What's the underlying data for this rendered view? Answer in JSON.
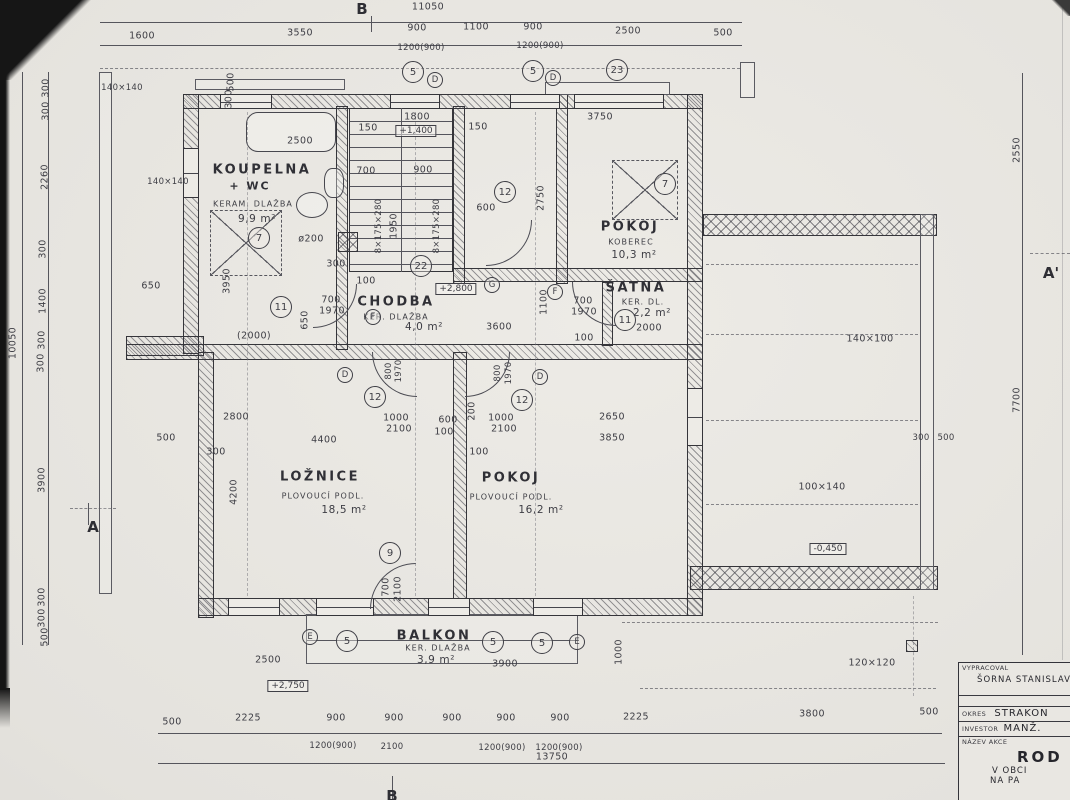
{
  "title_block": {
    "vypracoval_label": "VYPRACOVAL",
    "vypracoval": "ŠORNA STANISLAV",
    "okres_label": "OKRES",
    "okres": "STRAKON",
    "investor_label": "INVESTOR",
    "investor": "MANŽ.",
    "nazev_label": "NÁZEV AKCE",
    "nazev1": "ROD",
    "nazev2": "V OBCI",
    "nazev3": "NA PA"
  },
  "rooms": [
    {
      "name": "KOUPELNA + WC",
      "floor": "KERAM. DLAŽBA",
      "area": "9,9 m²"
    },
    {
      "name": "CHODBA",
      "floor": "KER. DLAŽBA",
      "area": "4,0 m²"
    },
    {
      "name": "POKOJ",
      "floor": "KOBEREC",
      "area": "10,3 m²"
    },
    {
      "name": "ŠATNA",
      "floor": "KER. DL.",
      "area": "2,2 m²"
    },
    {
      "name": "LOŽNICE",
      "floor": "PLOVOUCÍ PODL.",
      "area": "18,5 m²"
    },
    {
      "name": "POKOJ",
      "floor": "PLOVOUCÍ PODL.",
      "area": "16,2 m²"
    },
    {
      "name": "BALKON",
      "floor": "KER. DLAŽBA",
      "area": "3,9 m²"
    }
  ],
  "labels": [
    {
      "t": "B",
      "x": 362,
      "y": 9,
      "cls": "axis",
      "name": "axis-b-top"
    },
    {
      "t": "B",
      "x": 392,
      "y": 796,
      "cls": "axis",
      "name": "axis-b-bottom"
    },
    {
      "t": "A",
      "x": 93,
      "y": 527,
      "cls": "axis",
      "name": "section-a"
    },
    {
      "t": "A'",
      "x": 1051,
      "y": 273,
      "cls": "axis",
      "name": "section-a-prime"
    },
    {
      "t": "11050",
      "x": 428,
      "y": 7,
      "cls": "dim"
    },
    {
      "t": "1600",
      "x": 142,
      "y": 36,
      "cls": "dim"
    },
    {
      "t": "3550",
      "x": 300,
      "y": 33,
      "cls": "dim"
    },
    {
      "t": "900",
      "x": 417,
      "y": 28,
      "cls": "dim"
    },
    {
      "t": "1200(900)",
      "x": 421,
      "y": 48,
      "cls": "dim-sub"
    },
    {
      "t": "1100",
      "x": 476,
      "y": 27,
      "cls": "dim"
    },
    {
      "t": "900",
      "x": 533,
      "y": 27,
      "cls": "dim"
    },
    {
      "t": "1200(900)",
      "x": 540,
      "y": 46,
      "cls": "dim-sub"
    },
    {
      "t": "2500",
      "x": 628,
      "y": 31,
      "cls": "dim"
    },
    {
      "t": "500",
      "x": 723,
      "y": 33,
      "cls": "dim"
    },
    {
      "t": "10050",
      "x": 13,
      "y": 343,
      "cls": "dim",
      "rot": 1
    },
    {
      "t": "300",
      "x": 46,
      "y": 88,
      "cls": "dim",
      "rot": 1
    },
    {
      "t": "300",
      "x": 46,
      "y": 111,
      "cls": "dim",
      "rot": 1
    },
    {
      "t": "2260",
      "x": 45,
      "y": 177,
      "cls": "dim",
      "rot": 1
    },
    {
      "t": "300",
      "x": 43,
      "y": 249,
      "cls": "dim",
      "rot": 1
    },
    {
      "t": "1400",
      "x": 43,
      "y": 301,
      "cls": "dim",
      "rot": 1
    },
    {
      "t": "300",
      "x": 42,
      "y": 340,
      "cls": "dim",
      "rot": 1
    },
    {
      "t": "300",
      "x": 41,
      "y": 363,
      "cls": "dim",
      "rot": 1
    },
    {
      "t": "3900",
      "x": 42,
      "y": 480,
      "cls": "dim",
      "rot": 1
    },
    {
      "t": "300",
      "x": 42,
      "y": 597,
      "cls": "dim",
      "rot": 1
    },
    {
      "t": "300",
      "x": 42,
      "y": 618,
      "cls": "dim",
      "rot": 1
    },
    {
      "t": "500",
      "x": 45,
      "y": 637,
      "cls": "dim",
      "rot": 1
    },
    {
      "t": "2550",
      "x": 1017,
      "y": 150,
      "cls": "dim",
      "rot": 1
    },
    {
      "t": "7700",
      "x": 1017,
      "y": 400,
      "cls": "dim",
      "rot": 1
    },
    {
      "t": "500",
      "x": 172,
      "y": 722,
      "cls": "dim"
    },
    {
      "t": "2225",
      "x": 248,
      "y": 718,
      "cls": "dim"
    },
    {
      "t": "900",
      "x": 336,
      "y": 718,
      "cls": "dim"
    },
    {
      "t": "1200(900)",
      "x": 333,
      "y": 746,
      "cls": "dim-sub"
    },
    {
      "t": "900",
      "x": 394,
      "y": 718,
      "cls": "dim"
    },
    {
      "t": "2100",
      "x": 392,
      "y": 747,
      "cls": "dim-sub"
    },
    {
      "t": "900",
      "x": 452,
      "y": 718,
      "cls": "dim"
    },
    {
      "t": "900",
      "x": 506,
      "y": 718,
      "cls": "dim"
    },
    {
      "t": "1200(900)",
      "x": 502,
      "y": 748,
      "cls": "dim-sub"
    },
    {
      "t": "900",
      "x": 560,
      "y": 718,
      "cls": "dim"
    },
    {
      "t": "1200(900)",
      "x": 559,
      "y": 748,
      "cls": "dim-sub"
    },
    {
      "t": "2225",
      "x": 636,
      "y": 717,
      "cls": "dim"
    },
    {
      "t": "3800",
      "x": 812,
      "y": 714,
      "cls": "dim"
    },
    {
      "t": "500",
      "x": 929,
      "y": 712,
      "cls": "dim"
    },
    {
      "t": "13750",
      "x": 552,
      "y": 757,
      "cls": "dim"
    },
    {
      "t": "2500",
      "x": 300,
      "y": 141,
      "cls": "dim"
    },
    {
      "t": "1800",
      "x": 417,
      "y": 117,
      "cls": "dim"
    },
    {
      "t": "150",
      "x": 368,
      "y": 128,
      "cls": "dim"
    },
    {
      "t": "150",
      "x": 478,
      "y": 127,
      "cls": "dim"
    },
    {
      "t": "3750",
      "x": 600,
      "y": 117,
      "cls": "dim"
    },
    {
      "t": "700",
      "x": 366,
      "y": 171,
      "cls": "dim"
    },
    {
      "t": "900",
      "x": 423,
      "y": 170,
      "cls": "dim"
    },
    {
      "t": "8×175×280",
      "x": 379,
      "y": 226,
      "cls": "dim-sub",
      "rot": 1
    },
    {
      "t": "1950",
      "x": 394,
      "y": 226,
      "cls": "dim",
      "rot": 1
    },
    {
      "t": "8×175×280",
      "x": 437,
      "y": 226,
      "cls": "dim-sub",
      "rot": 1
    },
    {
      "t": "2750",
      "x": 541,
      "y": 198,
      "cls": "dim",
      "rot": 1
    },
    {
      "t": "600",
      "x": 486,
      "y": 208,
      "cls": "dim"
    },
    {
      "t": "ø200",
      "x": 311,
      "y": 239,
      "cls": "dim"
    },
    {
      "t": "300",
      "x": 336,
      "y": 264,
      "cls": "dim"
    },
    {
      "t": "100",
      "x": 366,
      "y": 281,
      "cls": "dim"
    },
    {
      "t": "3950",
      "x": 227,
      "y": 281,
      "cls": "dim",
      "rot": 1
    },
    {
      "t": "650",
      "x": 151,
      "y": 286,
      "cls": "dim"
    },
    {
      "t": "650",
      "x": 305,
      "y": 320,
      "cls": "dim",
      "rot": 1
    },
    {
      "t": "(2000)",
      "x": 254,
      "y": 336,
      "cls": "dim"
    },
    {
      "t": "700",
      "x": 331,
      "y": 300,
      "cls": "dim"
    },
    {
      "t": "1970",
      "x": 332,
      "y": 311,
      "cls": "dim"
    },
    {
      "t": "3600",
      "x": 499,
      "y": 327,
      "cls": "dim"
    },
    {
      "t": "1100",
      "x": 544,
      "y": 302,
      "cls": "dim",
      "rot": 1
    },
    {
      "t": "700",
      "x": 583,
      "y": 301,
      "cls": "dim"
    },
    {
      "t": "1970",
      "x": 584,
      "y": 312,
      "cls": "dim"
    },
    {
      "t": "100",
      "x": 584,
      "y": 338,
      "cls": "dim"
    },
    {
      "t": "2000",
      "x": 649,
      "y": 328,
      "cls": "dim"
    },
    {
      "t": "500",
      "x": 231,
      "y": 82,
      "cls": "dim",
      "rot": 1
    },
    {
      "t": "300",
      "x": 229,
      "y": 99,
      "cls": "dim",
      "rot": 1
    },
    {
      "t": "140×140",
      "x": 122,
      "y": 88,
      "cls": "dim-sub"
    },
    {
      "t": "140×140",
      "x": 168,
      "y": 182,
      "cls": "dim-sub"
    },
    {
      "t": "2800",
      "x": 236,
      "y": 417,
      "cls": "dim"
    },
    {
      "t": "1000",
      "x": 396,
      "y": 418,
      "cls": "dim"
    },
    {
      "t": "2100",
      "x": 399,
      "y": 429,
      "cls": "dim"
    },
    {
      "t": "600",
      "x": 448,
      "y": 420,
      "cls": "dim"
    },
    {
      "t": "100",
      "x": 444,
      "y": 432,
      "cls": "dim"
    },
    {
      "t": "200",
      "x": 472,
      "y": 411,
      "cls": "dim",
      "rot": 1
    },
    {
      "t": "1000",
      "x": 501,
      "y": 418,
      "cls": "dim"
    },
    {
      "t": "2100",
      "x": 504,
      "y": 429,
      "cls": "dim"
    },
    {
      "t": "2650",
      "x": 612,
      "y": 417,
      "cls": "dim"
    },
    {
      "t": "500",
      "x": 166,
      "y": 438,
      "cls": "dim"
    },
    {
      "t": "4400",
      "x": 324,
      "y": 440,
      "cls": "dim"
    },
    {
      "t": "300",
      "x": 216,
      "y": 452,
      "cls": "dim"
    },
    {
      "t": "100",
      "x": 479,
      "y": 452,
      "cls": "dim"
    },
    {
      "t": "3850",
      "x": 612,
      "y": 438,
      "cls": "dim"
    },
    {
      "t": "4200",
      "x": 234,
      "y": 492,
      "cls": "dim",
      "rot": 1
    },
    {
      "t": "700",
      "x": 386,
      "y": 587,
      "cls": "dim",
      "rot": 1
    },
    {
      "t": "2100",
      "x": 398,
      "y": 589,
      "cls": "dim",
      "rot": 1
    },
    {
      "t": "2500",
      "x": 268,
      "y": 660,
      "cls": "dim"
    },
    {
      "t": "3900",
      "x": 505,
      "y": 664,
      "cls": "dim"
    },
    {
      "t": "1000",
      "x": 619,
      "y": 652,
      "cls": "dim",
      "rot": 1
    },
    {
      "t": "140×100",
      "x": 870,
      "y": 339,
      "cls": "dim"
    },
    {
      "t": "100×140",
      "x": 822,
      "y": 487,
      "cls": "dim"
    },
    {
      "t": "120×120",
      "x": 872,
      "y": 663,
      "cls": "dim"
    },
    {
      "t": "300",
      "x": 921,
      "y": 438,
      "cls": "dim-sub"
    },
    {
      "t": "500",
      "x": 946,
      "y": 438,
      "cls": "dim-sub"
    },
    {
      "t": "+1,400",
      "x": 416,
      "y": 131,
      "cls": "box",
      "name": "elevation-plus-1400"
    },
    {
      "t": "+2,800",
      "x": 456,
      "y": 289,
      "cls": "box",
      "name": "elevation-plus-2800"
    },
    {
      "t": "+2,750",
      "x": 288,
      "y": 686,
      "cls": "box",
      "name": "elevation-plus-2750"
    },
    {
      "t": "-0,450",
      "x": 828,
      "y": 549,
      "cls": "box",
      "name": "elevation-minus-0450"
    },
    {
      "t": "KOUPELNA",
      "x": 262,
      "y": 170,
      "cls": "room",
      "name": "room-label-koupelna"
    },
    {
      "t": "+ WC",
      "x": 250,
      "y": 186,
      "cls": "room2",
      "name": "room-label-wc"
    },
    {
      "t": "KERAM. DLAŽBA",
      "x": 253,
      "y": 204,
      "cls": "room-sub"
    },
    {
      "t": "9,9 m²",
      "x": 257,
      "y": 219,
      "cls": "area"
    },
    {
      "t": "CHODBA",
      "x": 396,
      "y": 302,
      "cls": "room",
      "name": "room-label-chodba"
    },
    {
      "t": "KER. DLAŽBA",
      "x": 396,
      "y": 317,
      "cls": "room-sub"
    },
    {
      "t": "4,0 m²",
      "x": 424,
      "y": 327,
      "cls": "area"
    },
    {
      "t": "POKOJ",
      "x": 630,
      "y": 227,
      "cls": "room",
      "name": "room-label-pokoj-top"
    },
    {
      "t": "KOBEREC",
      "x": 631,
      "y": 242,
      "cls": "room-sub"
    },
    {
      "t": "10,3 m²",
      "x": 634,
      "y": 255,
      "cls": "area"
    },
    {
      "t": "ŠATNA",
      "x": 636,
      "y": 288,
      "cls": "room",
      "name": "room-label-satna"
    },
    {
      "t": "KER. DL.",
      "x": 643,
      "y": 302,
      "cls": "room-sub"
    },
    {
      "t": "2,2 m²",
      "x": 652,
      "y": 313,
      "cls": "area"
    },
    {
      "t": "LOŽNICE",
      "x": 320,
      "y": 477,
      "cls": "room",
      "name": "room-label-loznice"
    },
    {
      "t": "PLOVOUCÍ PODL.",
      "x": 323,
      "y": 496,
      "cls": "room-sub"
    },
    {
      "t": "18,5 m²",
      "x": 344,
      "y": 510,
      "cls": "area"
    },
    {
      "t": "POKOJ",
      "x": 511,
      "y": 478,
      "cls": "room",
      "name": "room-label-pokoj-bottom"
    },
    {
      "t": "PLOVOUCÍ PODL.",
      "x": 511,
      "y": 497,
      "cls": "room-sub"
    },
    {
      "t": "16,2 m²",
      "x": 541,
      "y": 510,
      "cls": "area"
    },
    {
      "t": "BALKON",
      "x": 434,
      "y": 636,
      "cls": "room",
      "name": "room-label-balkon"
    },
    {
      "t": "KER. DLAŽBA",
      "x": 438,
      "y": 648,
      "cls": "room-sub"
    },
    {
      "t": "3,9 m²",
      "x": 436,
      "y": 660,
      "cls": "area"
    },
    {
      "t": "5",
      "x": 413,
      "y": 72,
      "cls": "cn",
      "name": "marker-5"
    },
    {
      "t": "5",
      "x": 533,
      "y": 71,
      "cls": "cn",
      "name": "marker-5"
    },
    {
      "t": "23",
      "x": 617,
      "y": 70,
      "cls": "cn",
      "name": "marker-23"
    },
    {
      "t": "7",
      "x": 259,
      "y": 238,
      "cls": "cn",
      "name": "marker-7"
    },
    {
      "t": "7",
      "x": 665,
      "y": 184,
      "cls": "cn",
      "name": "marker-7"
    },
    {
      "t": "22",
      "x": 421,
      "y": 266,
      "cls": "cn",
      "name": "marker-22"
    },
    {
      "t": "12",
      "x": 505,
      "y": 192,
      "cls": "cn",
      "name": "marker-12"
    },
    {
      "t": "12",
      "x": 375,
      "y": 397,
      "cls": "cn",
      "name": "marker-12"
    },
    {
      "t": "12",
      "x": 522,
      "y": 400,
      "cls": "cn",
      "name": "marker-12"
    },
    {
      "t": "11",
      "x": 281,
      "y": 307,
      "cls": "cn",
      "name": "marker-11"
    },
    {
      "t": "11",
      "x": 625,
      "y": 320,
      "cls": "cn",
      "name": "marker-11"
    },
    {
      "t": "9",
      "x": 390,
      "y": 553,
      "cls": "cn",
      "name": "marker-9"
    },
    {
      "t": "5",
      "x": 347,
      "y": 641,
      "cls": "cn",
      "name": "marker-5"
    },
    {
      "t": "5",
      "x": 493,
      "y": 642,
      "cls": "cn",
      "name": "marker-5"
    },
    {
      "t": "5",
      "x": 542,
      "y": 643,
      "cls": "cn",
      "name": "marker-5"
    },
    {
      "t": "D",
      "x": 435,
      "y": 80,
      "cls": "cl",
      "name": "marker-d"
    },
    {
      "t": "D",
      "x": 553,
      "y": 78,
      "cls": "cl",
      "name": "marker-d"
    },
    {
      "t": "D",
      "x": 345,
      "y": 375,
      "cls": "cl",
      "name": "marker-d"
    },
    {
      "t": "D",
      "x": 540,
      "y": 377,
      "cls": "cl",
      "name": "marker-d"
    },
    {
      "t": "E",
      "x": 310,
      "y": 637,
      "cls": "cl",
      "name": "marker-e"
    },
    {
      "t": "E",
      "x": 577,
      "y": 642,
      "cls": "cl",
      "name": "marker-e"
    },
    {
      "t": "F",
      "x": 373,
      "y": 317,
      "cls": "cl",
      "name": "marker-f"
    },
    {
      "t": "F",
      "x": 555,
      "y": 292,
      "cls": "cl",
      "name": "marker-f"
    },
    {
      "t": "G",
      "x": 492,
      "y": 285,
      "cls": "cl",
      "name": "marker-g"
    },
    {
      "t": "800",
      "x": 389,
      "y": 371,
      "cls": "dim-sub",
      "rot": 1
    },
    {
      "t": "1970",
      "x": 399,
      "y": 371,
      "cls": "dim-sub",
      "rot": 1
    },
    {
      "t": "800",
      "x": 498,
      "y": 373,
      "cls": "dim-sub",
      "rot": 1
    },
    {
      "t": "1970",
      "x": 509,
      "y": 373,
      "cls": "dim-sub",
      "rot": 1
    }
  ]
}
